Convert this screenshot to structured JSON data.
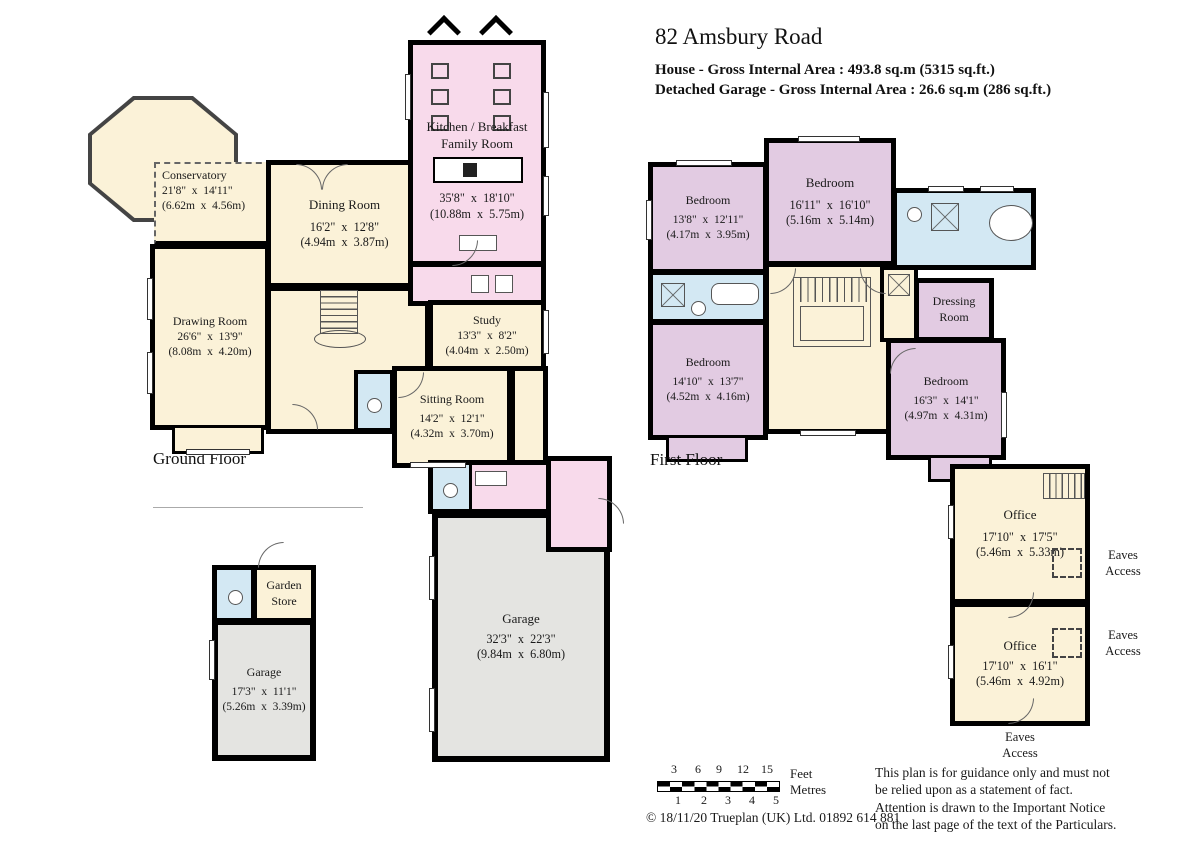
{
  "header": {
    "title": "82 Amsbury Road",
    "house_area": "House - Gross Internal Area  :  493.8 sq.m   (5315 sq.ft.)",
    "garage_area": "Detached Garage - Gross Internal Area  :  26.6 sq.m   (286 sq.ft.)"
  },
  "ground_floor": {
    "label": "Ground Floor",
    "conservatory": {
      "name": "Conservatory",
      "imp": "21'8\"  x  14'11\"",
      "met": "(6.62m  x  4.56m)"
    },
    "dining": {
      "name": "Dining Room",
      "imp": "16'2\"  x  12'8\"",
      "met": "(4.94m  x  3.87m)"
    },
    "kitchen": {
      "name1": "Kitchen / Breakfast",
      "name2": "Family Room",
      "imp": "35'8\"  x  18'10\"",
      "met": "(10.88m  x  5.75m)"
    },
    "drawing": {
      "name": "Drawing Room",
      "imp": "26'6\"  x  13'9\"",
      "met": "(8.08m  x  4.20m)"
    },
    "study": {
      "name": "Study",
      "imp": "13'3\"  x  8'2\"",
      "met": "(4.04m  x  2.50m)"
    },
    "sitting": {
      "name": "Sitting Room",
      "imp": "14'2\"  x  12'1\"",
      "met": "(4.32m  x  3.70m)"
    },
    "garage": {
      "name": "Garage",
      "imp": "32'3\"  x  22'3\"",
      "met": "(9.84m  x  6.80m)"
    }
  },
  "outbuilding": {
    "store": {
      "name1": "Garden",
      "name2": "Store"
    },
    "garage": {
      "name": "Garage",
      "imp": "17'3\"  x  11'1\"",
      "met": "(5.26m  x  3.39m)"
    }
  },
  "first_floor": {
    "label": "First Floor",
    "bedroom1": {
      "name": "Bedroom",
      "imp": "13'8\"  x  12'11\"",
      "met": "(4.17m  x  3.95m)"
    },
    "bedroom2": {
      "name": "Bedroom",
      "imp": "16'11\"  x  16'10\"",
      "met": "(5.16m  x  5.14m)"
    },
    "bedroom3": {
      "name": "Bedroom",
      "imp": "14'10\"  x  13'7\"",
      "met": "(4.52m  x  4.16m)"
    },
    "bedroom4": {
      "name": "Bedroom",
      "imp": "16'3\"  x  14'1\"",
      "met": "(4.97m  x  4.31m)"
    },
    "dressing": {
      "name1": "Dressing",
      "name2": "Room"
    }
  },
  "offices": {
    "office1": {
      "name": "Office",
      "imp": "17'10\"  x  17'5\"",
      "met": "(5.46m  x  5.33m)"
    },
    "office2": {
      "name": "Office",
      "imp": "17'10\"  x  16'1\"",
      "met": "(5.46m  x  4.92m)"
    },
    "eaves": {
      "line1": "Eaves",
      "line2": "Access"
    }
  },
  "scale_bar": {
    "feet_ticks": [
      "3",
      "6",
      "9",
      "12",
      "15"
    ],
    "metre_ticks": [
      "1",
      "2",
      "3",
      "4",
      "5"
    ],
    "feet_label": "Feet",
    "metres_label": "Metres"
  },
  "footer": {
    "copyright": "©  18/11/20  Trueplan  (UK) Ltd. 01892 614 881",
    "disclaimer": "This plan is for guidance only and must not be relied upon as a statement of fact. Attention is drawn to the Important Notice on the last page of the text of the Particulars."
  },
  "colors": {
    "room_cream": "#FBF2D8",
    "room_pink": "#F8DAEB",
    "room_lilac": "#E2CBE2",
    "room_blue": "#D3E8F3",
    "room_grey": "#E4E4E1",
    "wall": "#000000"
  }
}
